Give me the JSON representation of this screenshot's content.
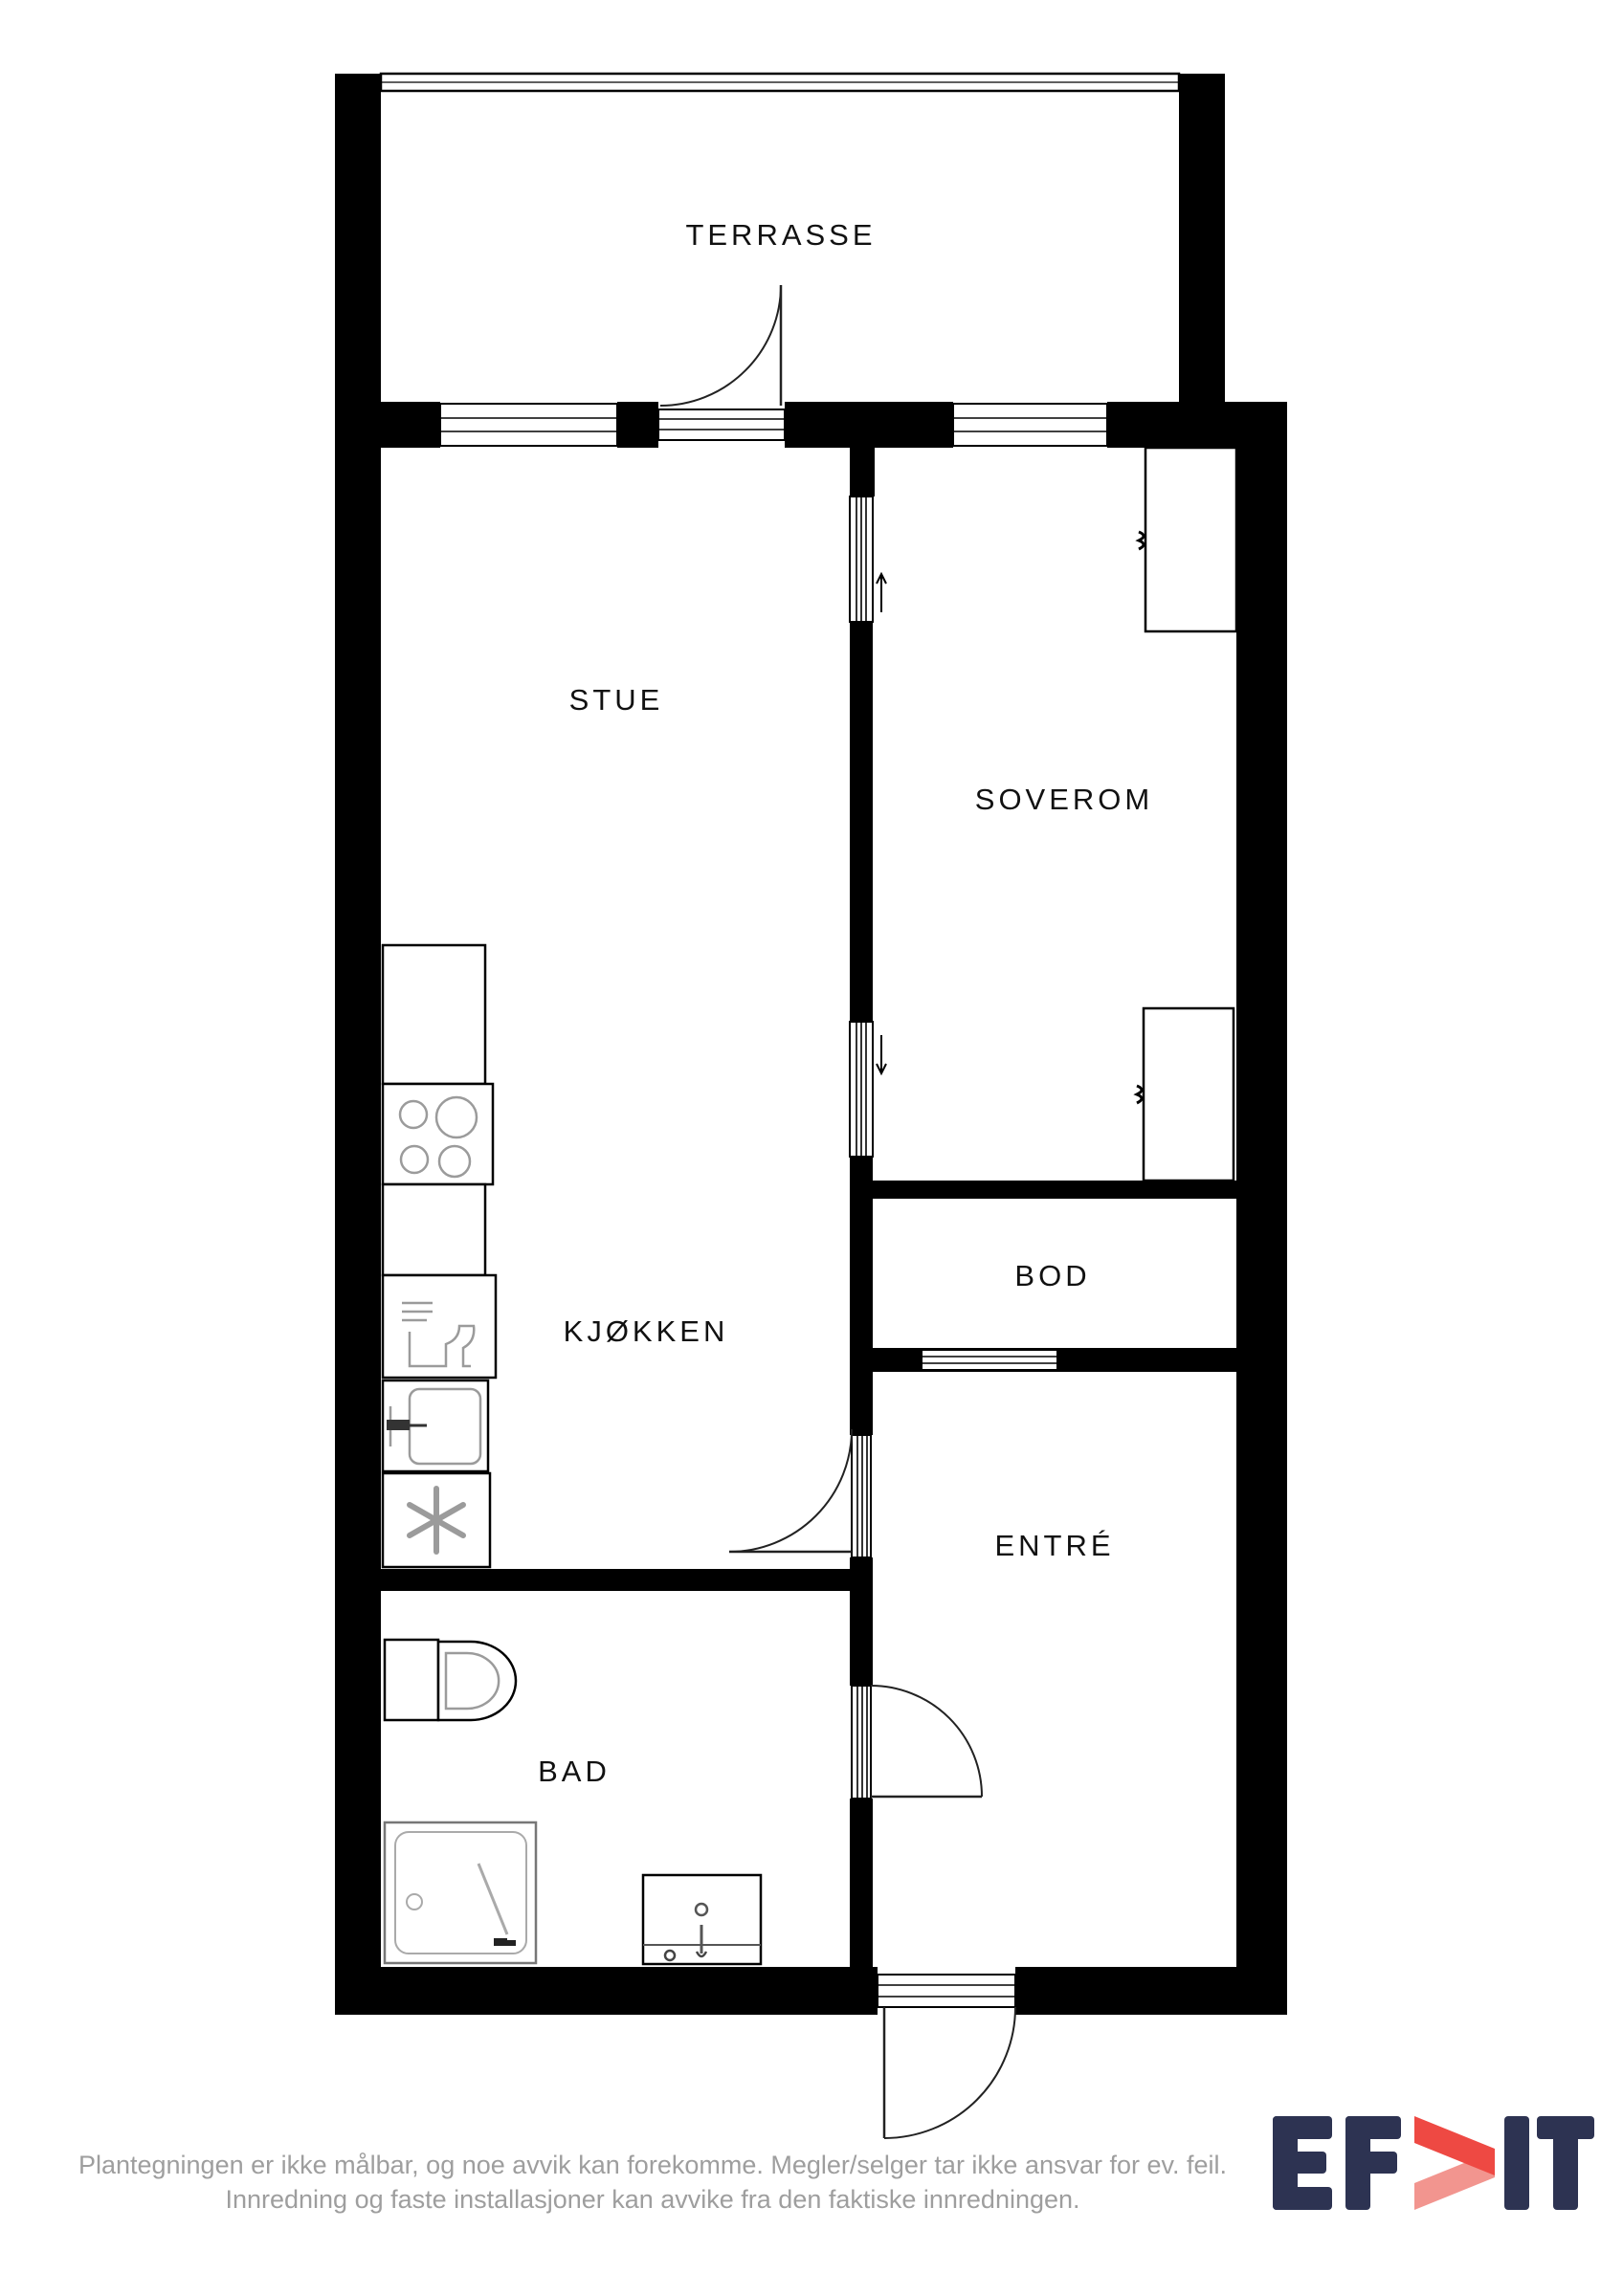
{
  "rooms": {
    "terrasse": "TERRASSE",
    "stue": "STUE",
    "soverom": "SOVEROM",
    "kjokken": "KJØKKEN",
    "bod": "BOD",
    "entre": "ENTRÉ",
    "bad": "BAD"
  },
  "footer": {
    "disclaimer_line1": "Plantegningen er ikke målbar, og noe avvik kan forekomme. Megler/selger tar ikke ansvar for ev. feil.",
    "disclaimer_line2": "Innredning og faste installasjoner kan avvike fra den faktiske innredningen."
  },
  "logo": {
    "text": "EFKT",
    "letter_e": "E",
    "letter_f": "F",
    "letter_i": "I",
    "letter_t": "T",
    "navy": "#2d3352",
    "red": "#ee4943",
    "red_light": "#f2958f"
  },
  "colors": {
    "wall": "#000000",
    "label": "#111111",
    "fixture_gray": "#9b9b9b",
    "disclaimer_text": "#9e9e9e",
    "background": "#ffffff"
  },
  "icons": {
    "cooktop": "cooktop-burners-icon",
    "dishwasher": "dishwasher-icon",
    "sink": "kitchen-sink-icon",
    "fridge": "fridge-snowflake-icon",
    "toilet": "toilet-icon",
    "shower": "shower-icon",
    "vanity": "bathroom-sink-icon",
    "wardrobe": "wardrobe-icon",
    "door_swing": "door-swing-arc-icon",
    "window": "window-icon",
    "sliding_arrow": "sliding-direction-arrow-icon"
  }
}
